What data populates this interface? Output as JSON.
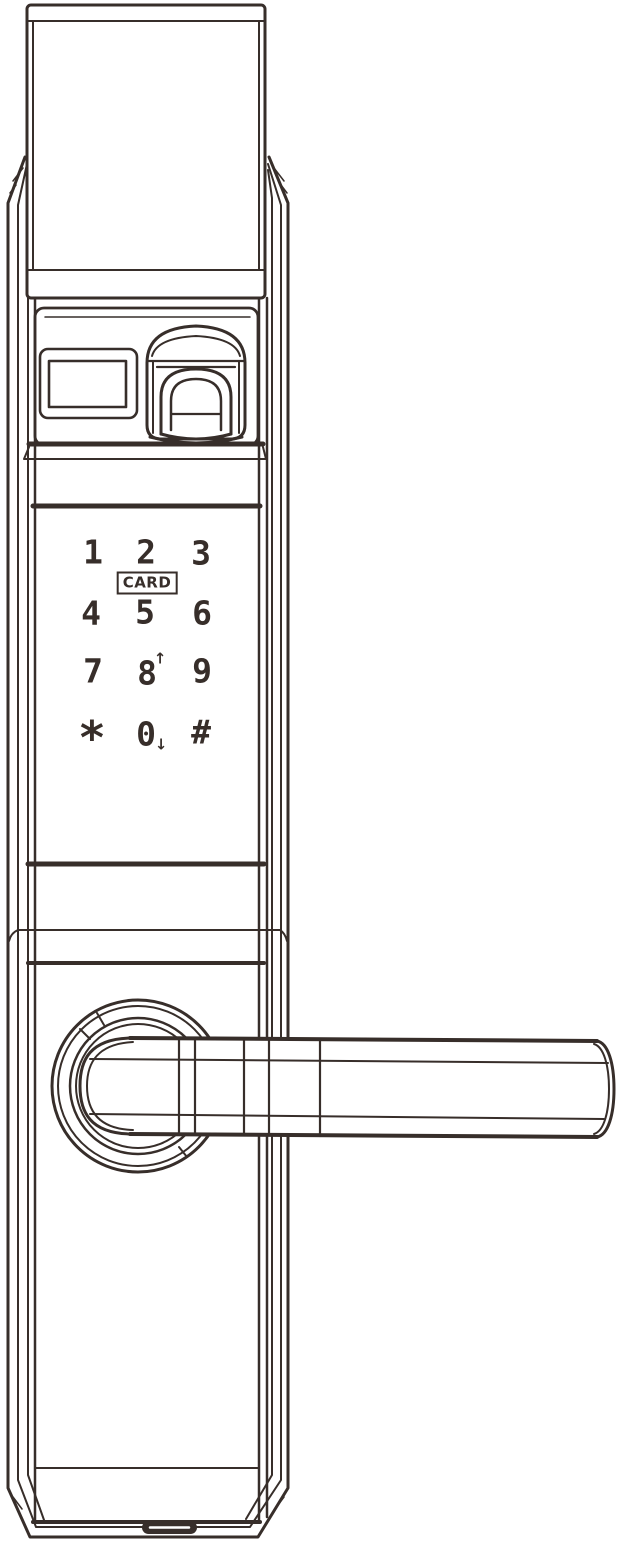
{
  "illustration": {
    "description": "Line drawing of a smart door lock, front view, with top cover, display window, fingerprint scanner, touch keypad, card reader label and lever handle"
  },
  "colors": {
    "ink": "#372e2a",
    "background": "#ffffff"
  },
  "keypad": {
    "keys": [
      [
        "1",
        "2",
        "3"
      ],
      [
        "4",
        "5",
        "6"
      ],
      [
        "7",
        "8",
        "9"
      ],
      [
        "*",
        "0",
        "#"
      ]
    ],
    "card_label": "CARD",
    "scroll_up_symbol": "↑",
    "scroll_down_symbol": "↓"
  },
  "parts": {
    "top_cap": "top-cover",
    "display": "display-window",
    "fingerprint": "fingerprint-scanner",
    "keypad": "touch-keypad",
    "rose": "handle-rose",
    "handle": "lever-handle",
    "port": "bottom-port"
  }
}
